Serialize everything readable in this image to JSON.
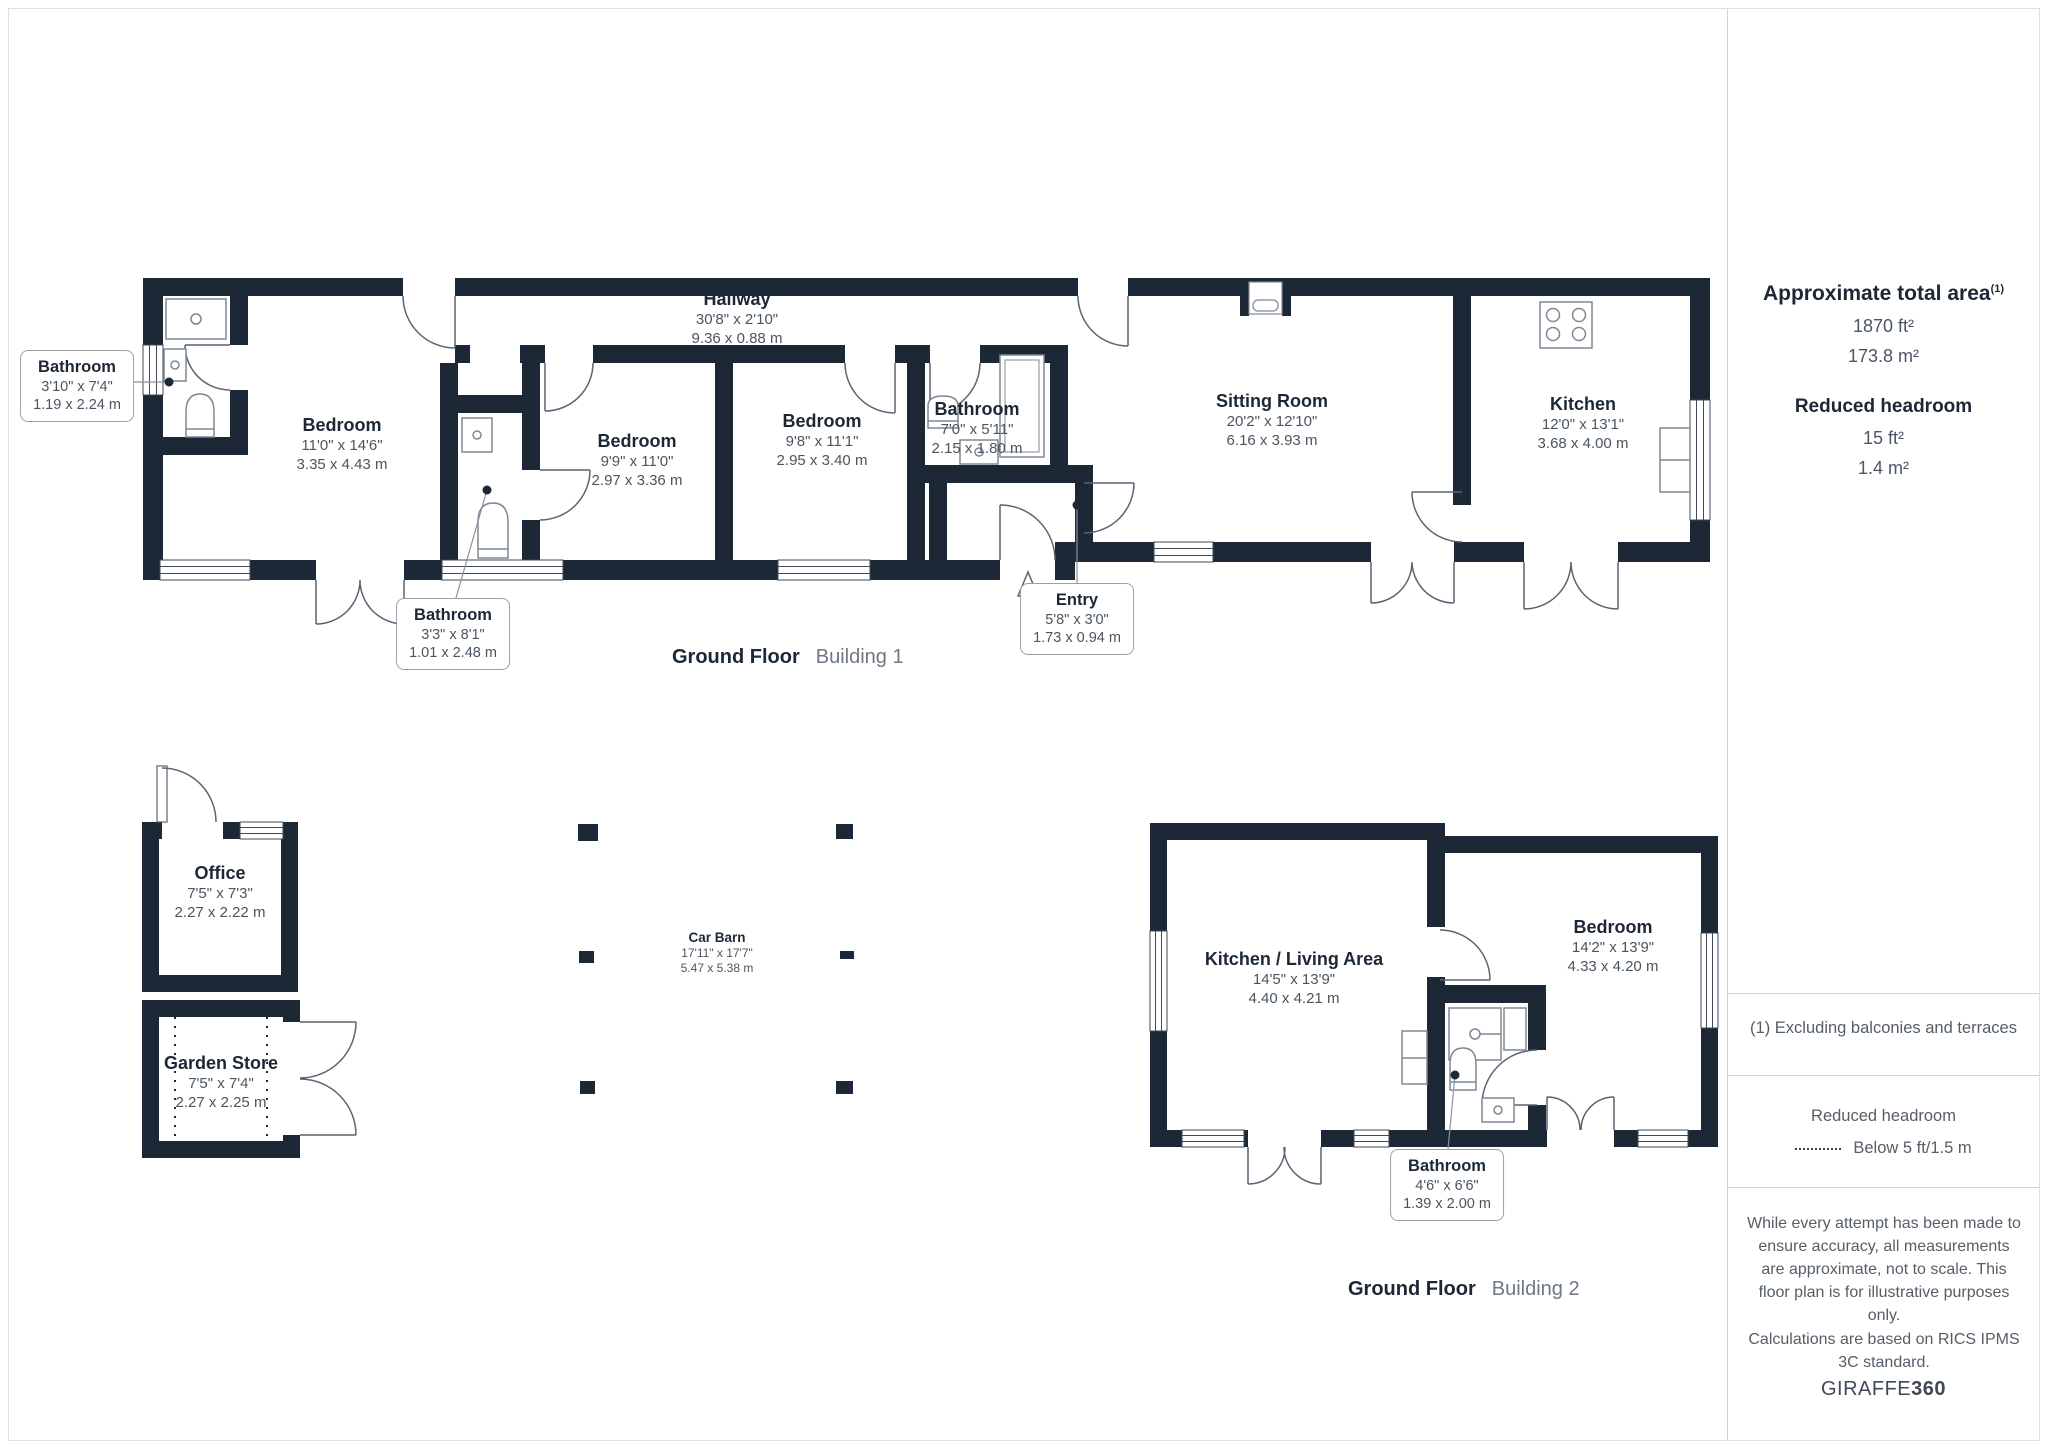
{
  "colors": {
    "wall": "#1d2836",
    "line": "#5a6472",
    "fixture": "#7e8894",
    "dark_text": "#1d2836",
    "muted_text": "#4a5560",
    "light_text": "#6e7883",
    "divider": "#cfd3d8"
  },
  "sidebar": {
    "total_area": {
      "title": "Approximate total area",
      "superscript": "(1)",
      "imperial": "1870 ft²",
      "metric": "173.8 m²"
    },
    "reduced_headroom": {
      "title": "Reduced headroom",
      "imperial": "15 ft²",
      "metric": "1.4 m²"
    },
    "footnote": "(1) Excluding balconies and terraces",
    "legend": {
      "title": "Reduced headroom",
      "label": "Below 5 ft/1.5 m"
    },
    "disclaimer_1": "While every attempt has been made to ensure accuracy, all measurements are approximate, not to scale. This floor plan is for illustrative purposes only.",
    "disclaimer_2": "Calculations are based on RICS IPMS 3C standard.",
    "brand": {
      "name": "GIRAFFE",
      "suffix": "360"
    }
  },
  "building1": {
    "caption": {
      "floor": "Ground Floor",
      "building": "Building 1"
    },
    "rooms": {
      "bathroom_left": {
        "name": "Bathroom",
        "imperial": "3'10\" x 7'4\"",
        "metric": "1.19 x 2.24 m"
      },
      "bedroom_1": {
        "name": "Bedroom",
        "imperial": "11'0\" x 14'6\"",
        "metric": "3.35 x 4.43 m"
      },
      "hallway": {
        "name": "Hallway",
        "imperial": "30'8\" x 2'10\"",
        "metric": "9.36 x 0.88 m"
      },
      "bathroom_small": {
        "name": "Bathroom",
        "imperial": "3'3\" x 8'1\"",
        "metric": "1.01 x 2.48 m"
      },
      "bedroom_2": {
        "name": "Bedroom",
        "imperial": "9'9\" x 11'0\"",
        "metric": "2.97 x 3.36 m"
      },
      "bedroom_3": {
        "name": "Bedroom",
        "imperial": "9'8\" x 11'1\"",
        "metric": "2.95 x 3.40 m"
      },
      "bathroom_mid": {
        "name": "Bathroom",
        "imperial": "7'0\" x 5'11\"",
        "metric": "2.15 x 1.80 m"
      },
      "sitting_room": {
        "name": "Sitting Room",
        "imperial": "20'2\" x 12'10\"",
        "metric": "6.16 x 3.93 m"
      },
      "kitchen": {
        "name": "Kitchen",
        "imperial": "12'0\" x 13'1\"",
        "metric": "3.68 x 4.00 m"
      },
      "entry": {
        "name": "Entry",
        "imperial": "5'8\" x 3'0\"",
        "metric": "1.73 x 0.94 m"
      }
    }
  },
  "outbuildings": {
    "office": {
      "name": "Office",
      "imperial": "7'5\" x 7'3\"",
      "metric": "2.27 x 2.22 m"
    },
    "garden_store": {
      "name": "Garden Store",
      "imperial": "7'5\" x 7'4\"",
      "metric": "2.27 x 2.25 m"
    },
    "car_barn": {
      "name": "Car Barn",
      "imperial": "17'11\" x 17'7\"",
      "metric": "5.47 x 5.38 m"
    }
  },
  "building2": {
    "caption": {
      "floor": "Ground Floor",
      "building": "Building 2"
    },
    "rooms": {
      "kitchen_living": {
        "name": "Kitchen / Living Area",
        "imperial": "14'5\" x 13'9\"",
        "metric": "4.40 x 4.21 m"
      },
      "bedroom": {
        "name": "Bedroom",
        "imperial": "14'2\" x 13'9\"",
        "metric": "4.33 x 4.20 m"
      },
      "bathroom": {
        "name": "Bathroom",
        "imperial": "4'6\" x 6'6\"",
        "metric": "1.39 x 2.00 m"
      }
    }
  }
}
